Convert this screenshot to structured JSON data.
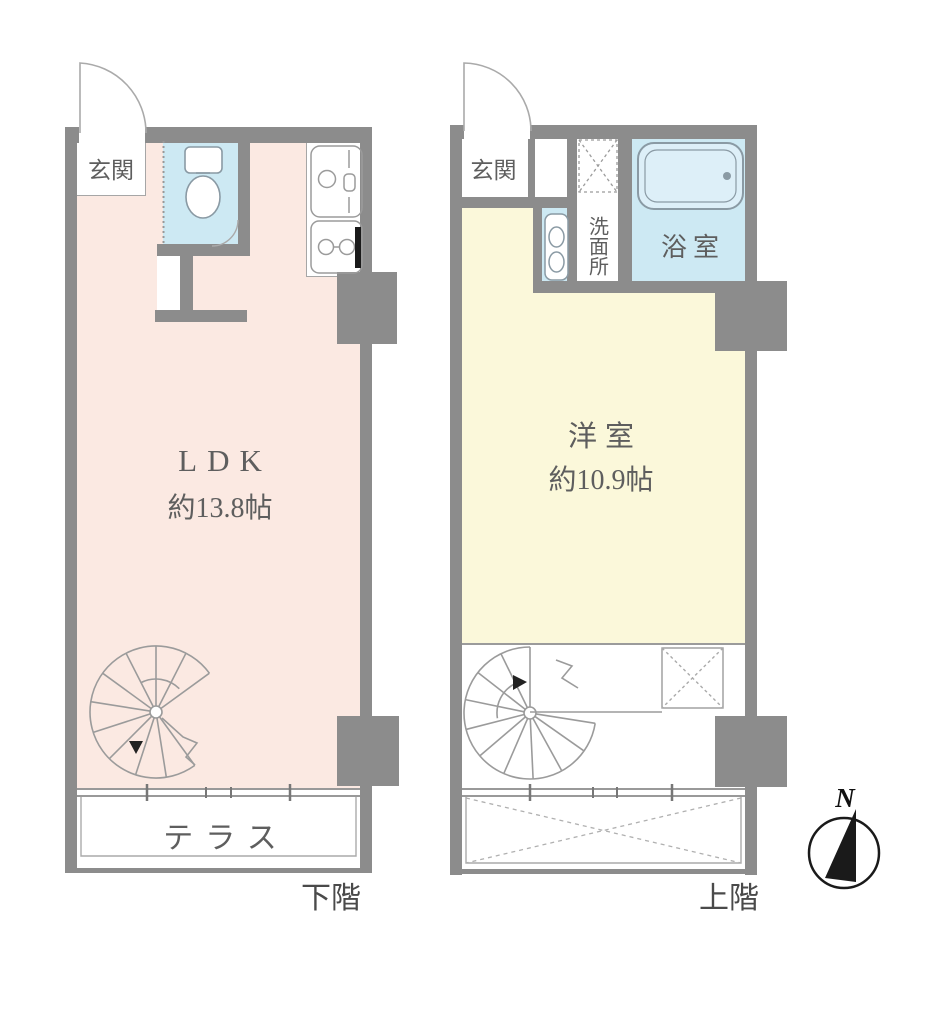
{
  "lower_floor": {
    "floor_label": "下階",
    "entrance": "玄関",
    "room": "LDK",
    "size": "約13.8帖",
    "terrace": "テラス"
  },
  "upper_floor": {
    "floor_label": "上階",
    "entrance": "玄関",
    "room": "洋室",
    "size": "約10.9帖",
    "washroom": "洗面所",
    "bathroom": "浴室"
  },
  "compass": {
    "north": "N"
  },
  "colors": {
    "wall": "#8c8c8c",
    "line": "#9b9b9b",
    "pink": "#fbe9e2",
    "yellow": "#fbf8da",
    "blue": "#cde9f3",
    "tub": "#ddeff8",
    "text": "#5e5e5e",
    "textdark": "#4a4a4a"
  }
}
